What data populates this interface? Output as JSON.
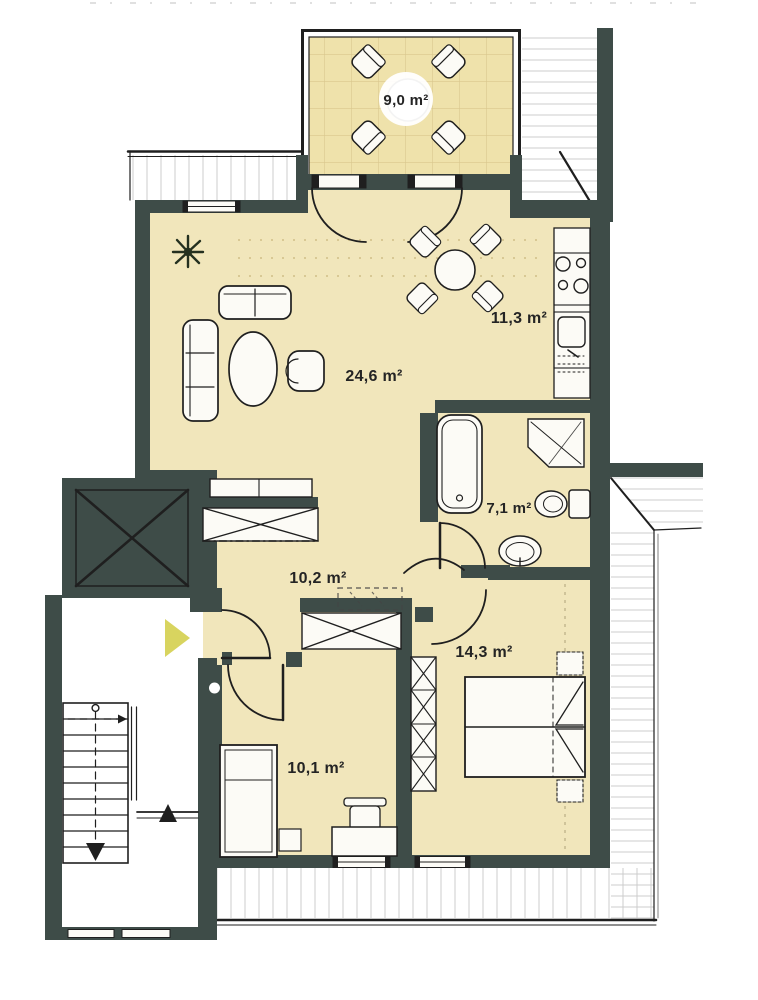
{
  "plan": {
    "rooms": [
      {
        "name": "balcony",
        "area_label": "9,0 m²"
      },
      {
        "name": "living-room",
        "area_label": "24,6 m²"
      },
      {
        "name": "kitchen",
        "area_label": "11,3 m²"
      },
      {
        "name": "bathroom",
        "area_label": "7,1 m²"
      },
      {
        "name": "hallway",
        "area_label": "10,2 m²"
      },
      {
        "name": "bedroom-large",
        "area_label": "14,3 m²"
      },
      {
        "name": "bedroom-small",
        "area_label": "10,1 m²"
      }
    ],
    "symbols": {
      "elevator": "boxed-x",
      "wardrobe": "crossed-box",
      "washing_machine": "dashed-box",
      "staircase_down_arrow": "▼",
      "half_landing_up_arrow": "▲",
      "entry_arrow": "▶"
    },
    "colors": {
      "wall": "#3e4c48",
      "floor": "#f1e6bb",
      "balcony_floor": "#efe2ab",
      "tile_grid": "#d9c78d",
      "hatch_line": "#cccccc",
      "outline": "#1f1f1f",
      "entry_arrow": "#d8d45f",
      "paper": "#ffffff"
    }
  }
}
